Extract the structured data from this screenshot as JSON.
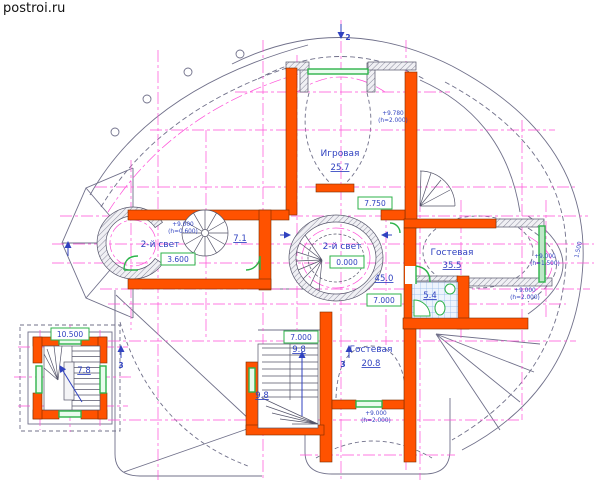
{
  "watermark": "postroi.ru",
  "colors": {
    "wall": "#ff5200",
    "axis": "#ff4fd8",
    "label": "#3042c0",
    "green": "#2db34a",
    "outline": "#70708a"
  },
  "rooms": {
    "igrovaya": {
      "name": "Игровая",
      "area": "25.7"
    },
    "gostevaya_east": {
      "name": "Гостевая",
      "area": "35.5"
    },
    "gostevaya_south": {
      "name": "Гостевая",
      "area": "20.8"
    },
    "svet_center": {
      "name": "2-й свет",
      "area": "45.0"
    },
    "svet_west": {
      "name": "2-й свет"
    },
    "hall": {
      "area": "7.1"
    },
    "bathroom": {
      "area": "5.4"
    },
    "stair_main": {
      "area": "9.8"
    },
    "stair_lower": {
      "area": "9.8"
    },
    "tower_stair": {
      "area": "7.8"
    }
  },
  "elevations": {
    "center": "0.000",
    "west_hall": "3.600",
    "east": "7.000",
    "stair": "7.000",
    "north": "7.750",
    "tower": "10.500"
  },
  "heights": {
    "igrovaya_l1": "+9.780",
    "igrovaya_l2": "(h=2.000)",
    "spiral_l1": "+9.000",
    "spiral_l2": "(h=0.600)",
    "bay_l1": "+9.000",
    "bay_l2": "(h=1.500)",
    "bay2_l1": "+9.000",
    "bay2_l2": "(h=2.000)",
    "south_l1": "+9.000",
    "south_l2": "(h=2.000)",
    "radius": "1.500"
  },
  "sections": {
    "top": "2",
    "south": "3",
    "tower": "3"
  }
}
